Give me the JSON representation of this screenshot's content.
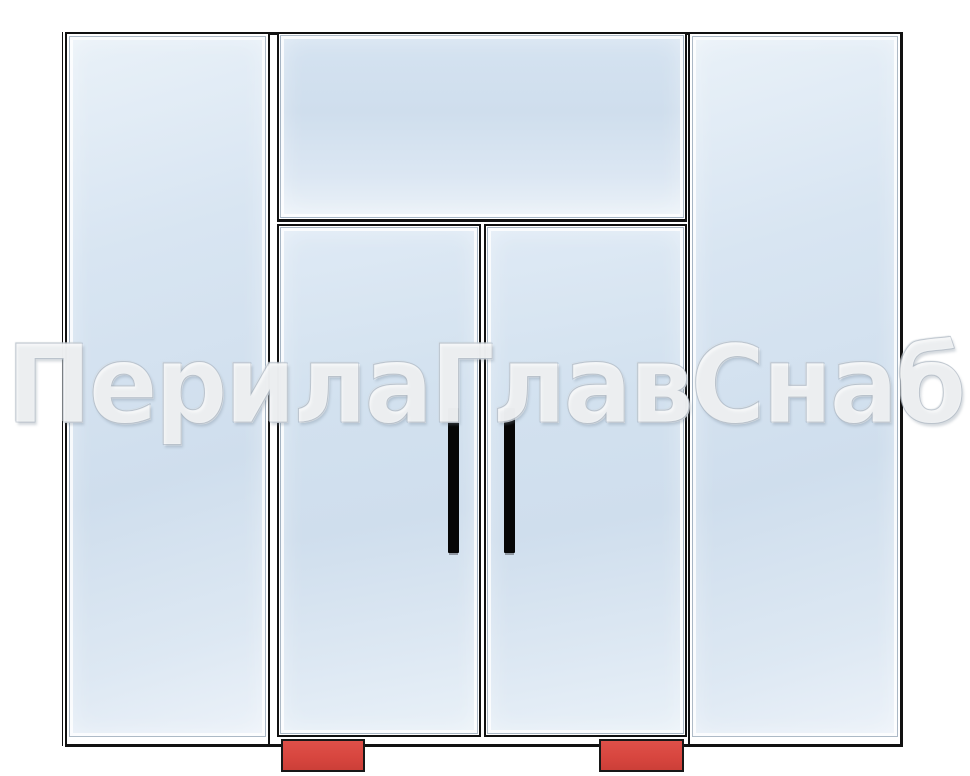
{
  "watermark": {
    "text": "ПерилаГлавСнаб"
  },
  "colors": {
    "frame": "#111111",
    "glass_mid": "#cfdeed",
    "glass_light": "#e9f1f8",
    "floor_closer_red": "#d8463f",
    "handle_black": "#060606"
  }
}
